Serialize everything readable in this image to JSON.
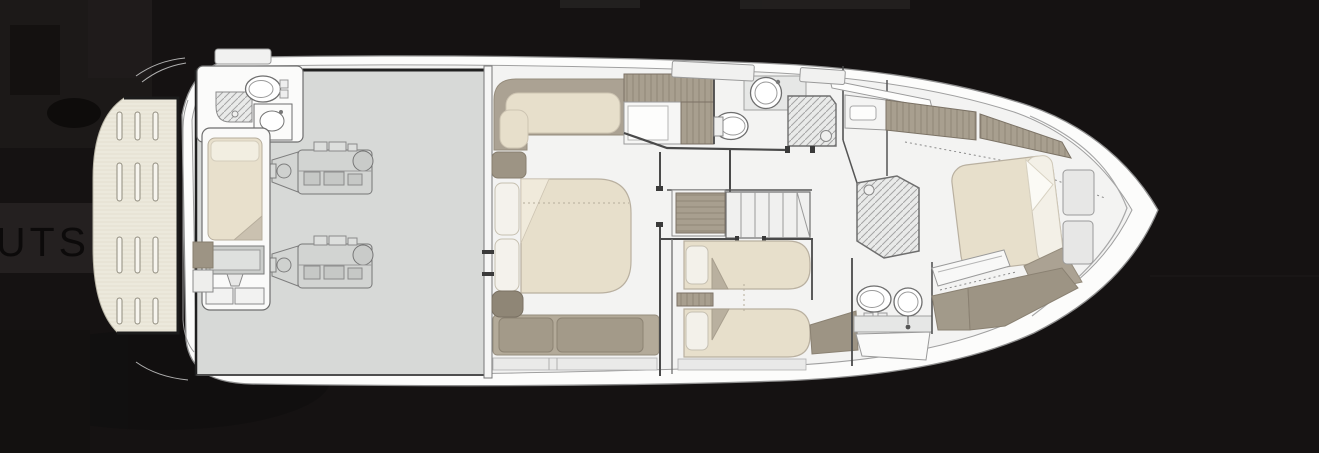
{
  "page": {
    "width": 1319,
    "height": 453,
    "background_color": "#151212"
  },
  "side_panel": {
    "layouts_fragment": "UTS",
    "band_color": "#242020",
    "text_color": "#0c0a0a"
  },
  "floor_plan": {
    "type": "yacht-lower-deck-plan",
    "orientation": "bow-pointing-right",
    "colors": {
      "hull": "#fcfcfb",
      "interior_floor": "#f3f3f2",
      "engine_room_floor": "#d7d9d7",
      "mattress": "#e7dfcb",
      "pillow": "#f4f2ec",
      "wood_joinery": "#a89f8f",
      "upholstery": "#aba293",
      "teak_platform": "#ece9dc",
      "outline": "#6e6e6e",
      "bulkhead": "#202020"
    },
    "areas": [
      {
        "name": "swim-platform",
        "features": [
          "teak-grating-slats"
        ]
      },
      {
        "name": "crew-bathroom",
        "features": [
          "toilet",
          "washbasin",
          "shower"
        ]
      },
      {
        "name": "crew-cabin",
        "features": [
          "single-berth",
          "tv-cabinet",
          "drawers"
        ]
      },
      {
        "name": "engine-room",
        "features": [
          "port-engine",
          "starboard-engine"
        ]
      },
      {
        "name": "master-cabin",
        "features": [
          "double-bed",
          "l-shaped-sofa",
          "aft-sofa",
          "wardrobe"
        ]
      },
      {
        "name": "master-bathroom",
        "features": [
          "toilet",
          "washbasin",
          "shower"
        ]
      },
      {
        "name": "staircase",
        "features": [
          "steps",
          "wardrobe"
        ]
      },
      {
        "name": "twin-guest-cabin",
        "features": [
          "single-bed",
          "single-bed",
          "nightstand"
        ]
      },
      {
        "name": "guest-shower",
        "features": [
          "shower-tray"
        ]
      },
      {
        "name": "guest-bathroom",
        "features": [
          "toilet",
          "washbasin",
          "vanity"
        ]
      },
      {
        "name": "vip-cabin",
        "features": [
          "double-bed",
          "side-steps",
          "wardrobes"
        ]
      }
    ]
  }
}
